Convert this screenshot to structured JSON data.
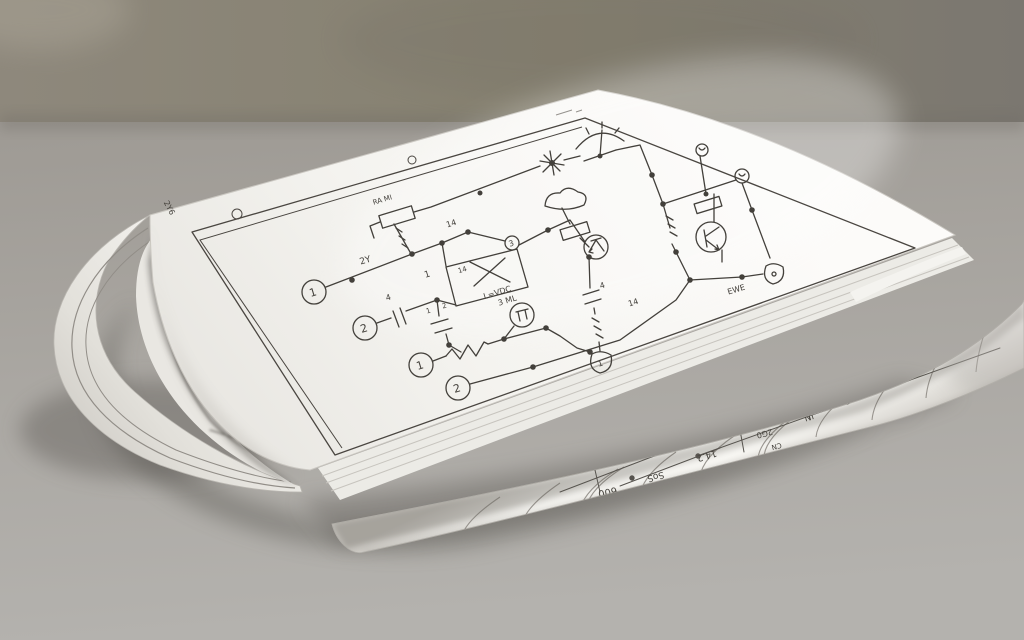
{
  "scene": {
    "description": "Photograph of a folded paper booklet printed with a hand-drawn electronic circuit schematic, lying on a gray table in front of a gray wall",
    "colors": {
      "wall_left": "#8e887c",
      "wall_right": "#7b7770",
      "table_top": "#9e9a94",
      "table_bottom": "#b4b2ae",
      "paper": "#f6f5f1",
      "paper_edge": "#d8d5cf",
      "ink": "#43403b"
    }
  },
  "top_page": {
    "terminals": {
      "t1": "1",
      "t2": "2",
      "t3": "1",
      "t4": "2"
    },
    "labels": {
      "wire_2y": "2Y",
      "wire_14": "14",
      "junction_3": "3",
      "ic_pin_1": "1",
      "ic_inner_14": "14",
      "ic_value": "L=VDC",
      "component_top_left": "RA MI",
      "cap_left_pin": "4",
      "cap_mid_pin_1": "1",
      "cap_mid_pin_2": "2",
      "cap_right_pin": "4",
      "buzzer": "3 ML",
      "rail_14": "14",
      "transistor_tag": "EWE",
      "d_terminal": "1",
      "margin_code": "2Y6"
    }
  },
  "inner_page": {
    "labels": {
      "r1": "0.0",
      "r2": "8.2"
    }
  },
  "rolled_page": {
    "labels": [
      "600",
      "SoS",
      "14.2",
      "2G0",
      "CN",
      "IN",
      "O",
      "NOS"
    ]
  }
}
